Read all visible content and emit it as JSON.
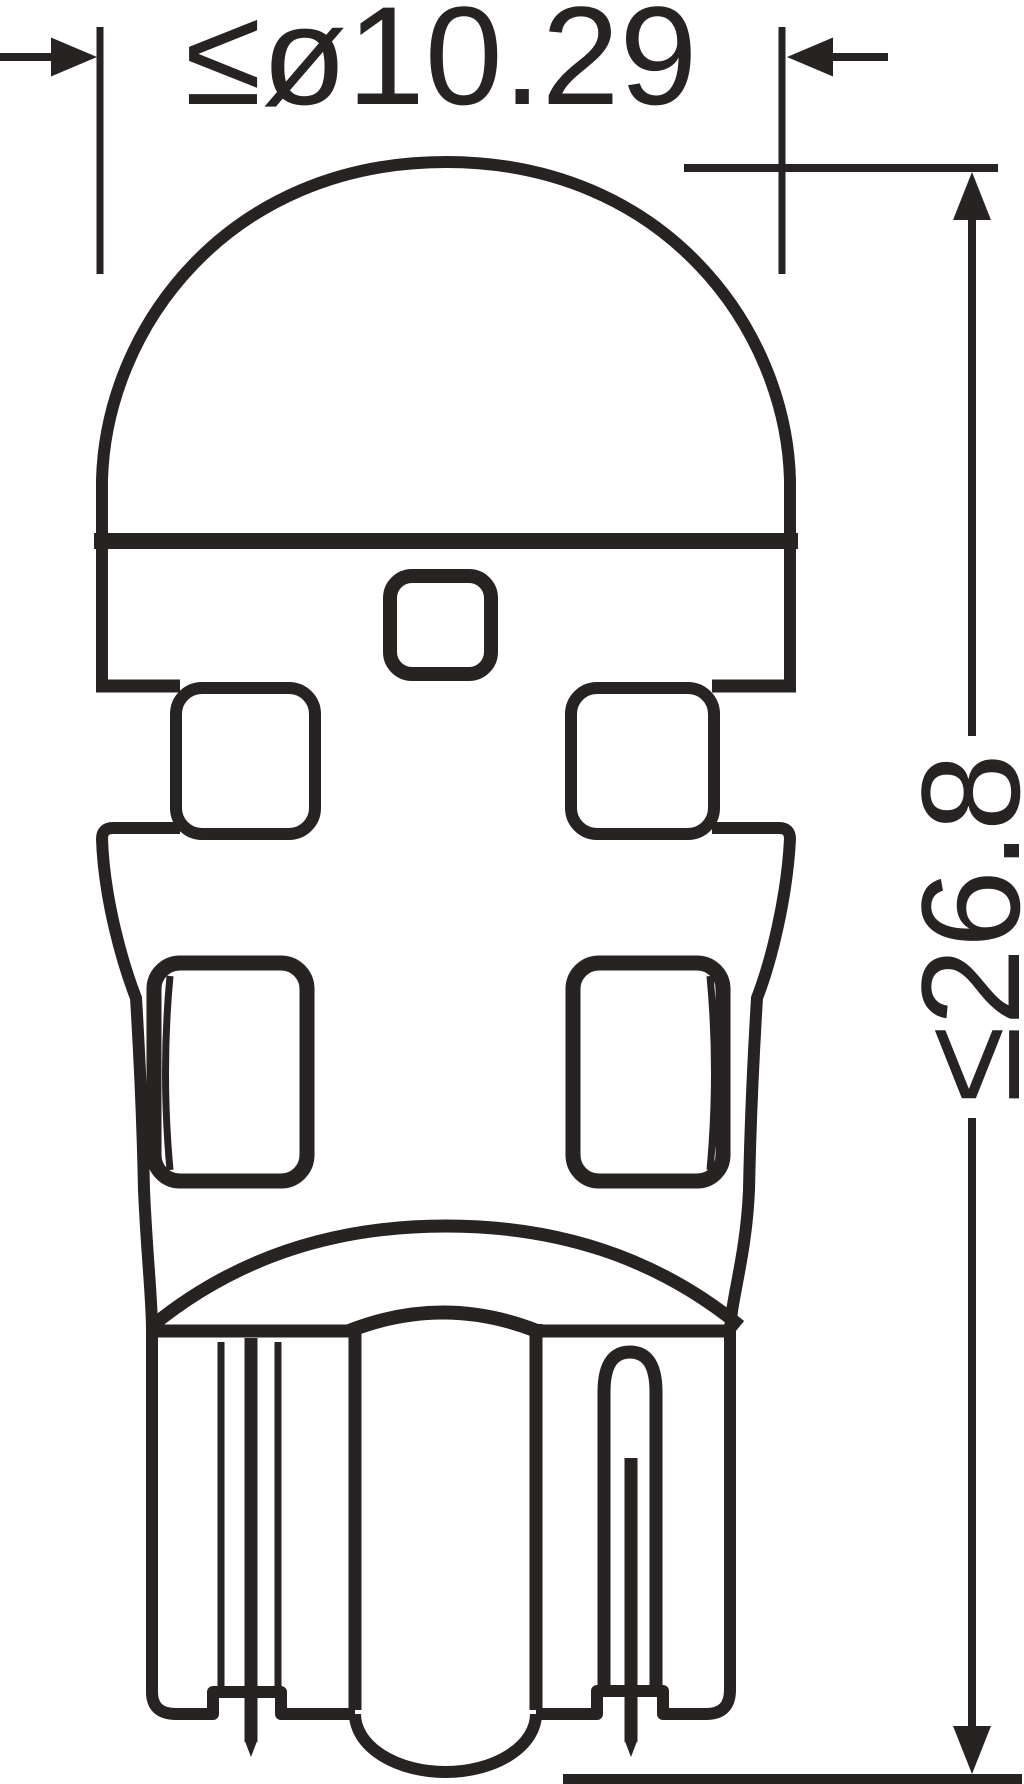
{
  "canvas": {
    "width_px": 1024,
    "height_px": 1784,
    "background_color": "#ffffff",
    "line_color": "#272322"
  },
  "drawing": {
    "kind": "technical-dimension-drawing",
    "view": "bulb-side-view-outline",
    "dimensions": {
      "diameter": {
        "label": "≤ø10.29",
        "value": 10.29,
        "constraint_symbol": "≤",
        "diameter_symbol": "ø"
      },
      "overall_length": {
        "label": "≤26.8",
        "value": 26.8,
        "constraint_symbol": "≤"
      }
    }
  }
}
